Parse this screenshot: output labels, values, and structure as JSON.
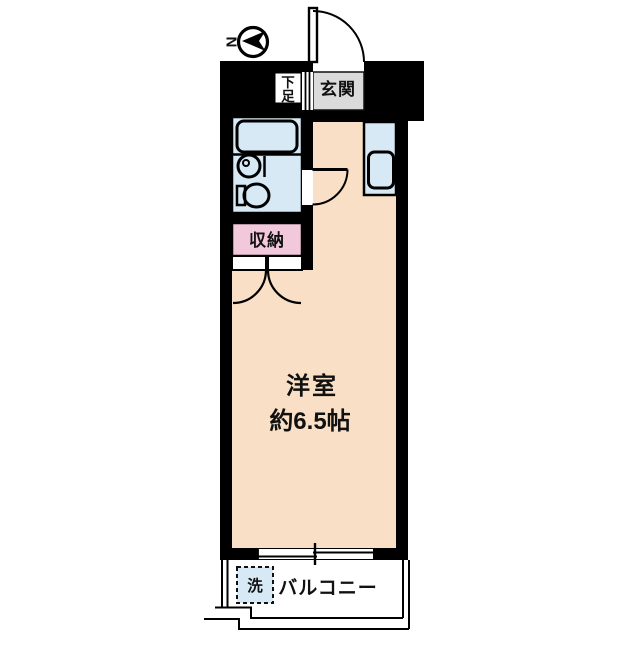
{
  "plan": {
    "compass": {
      "label": "N"
    },
    "rooms": {
      "entrance": {
        "label": "玄関"
      },
      "shoe_box": {
        "char1": "下",
        "char2": "足"
      },
      "storage": {
        "label": "収納"
      },
      "main_room": {
        "name": "洋室",
        "size": "約6.5帖"
      },
      "balcony": {
        "label": "バルコニー"
      },
      "laundry": {
        "label": "洗"
      }
    },
    "colors": {
      "room": "#F9DFC6",
      "water": "#D6E9F5",
      "storage": "#F2C9DC",
      "entrance_floor": "#DBDBDB",
      "wall": "#000000",
      "background": "#FFFFFF"
    }
  }
}
